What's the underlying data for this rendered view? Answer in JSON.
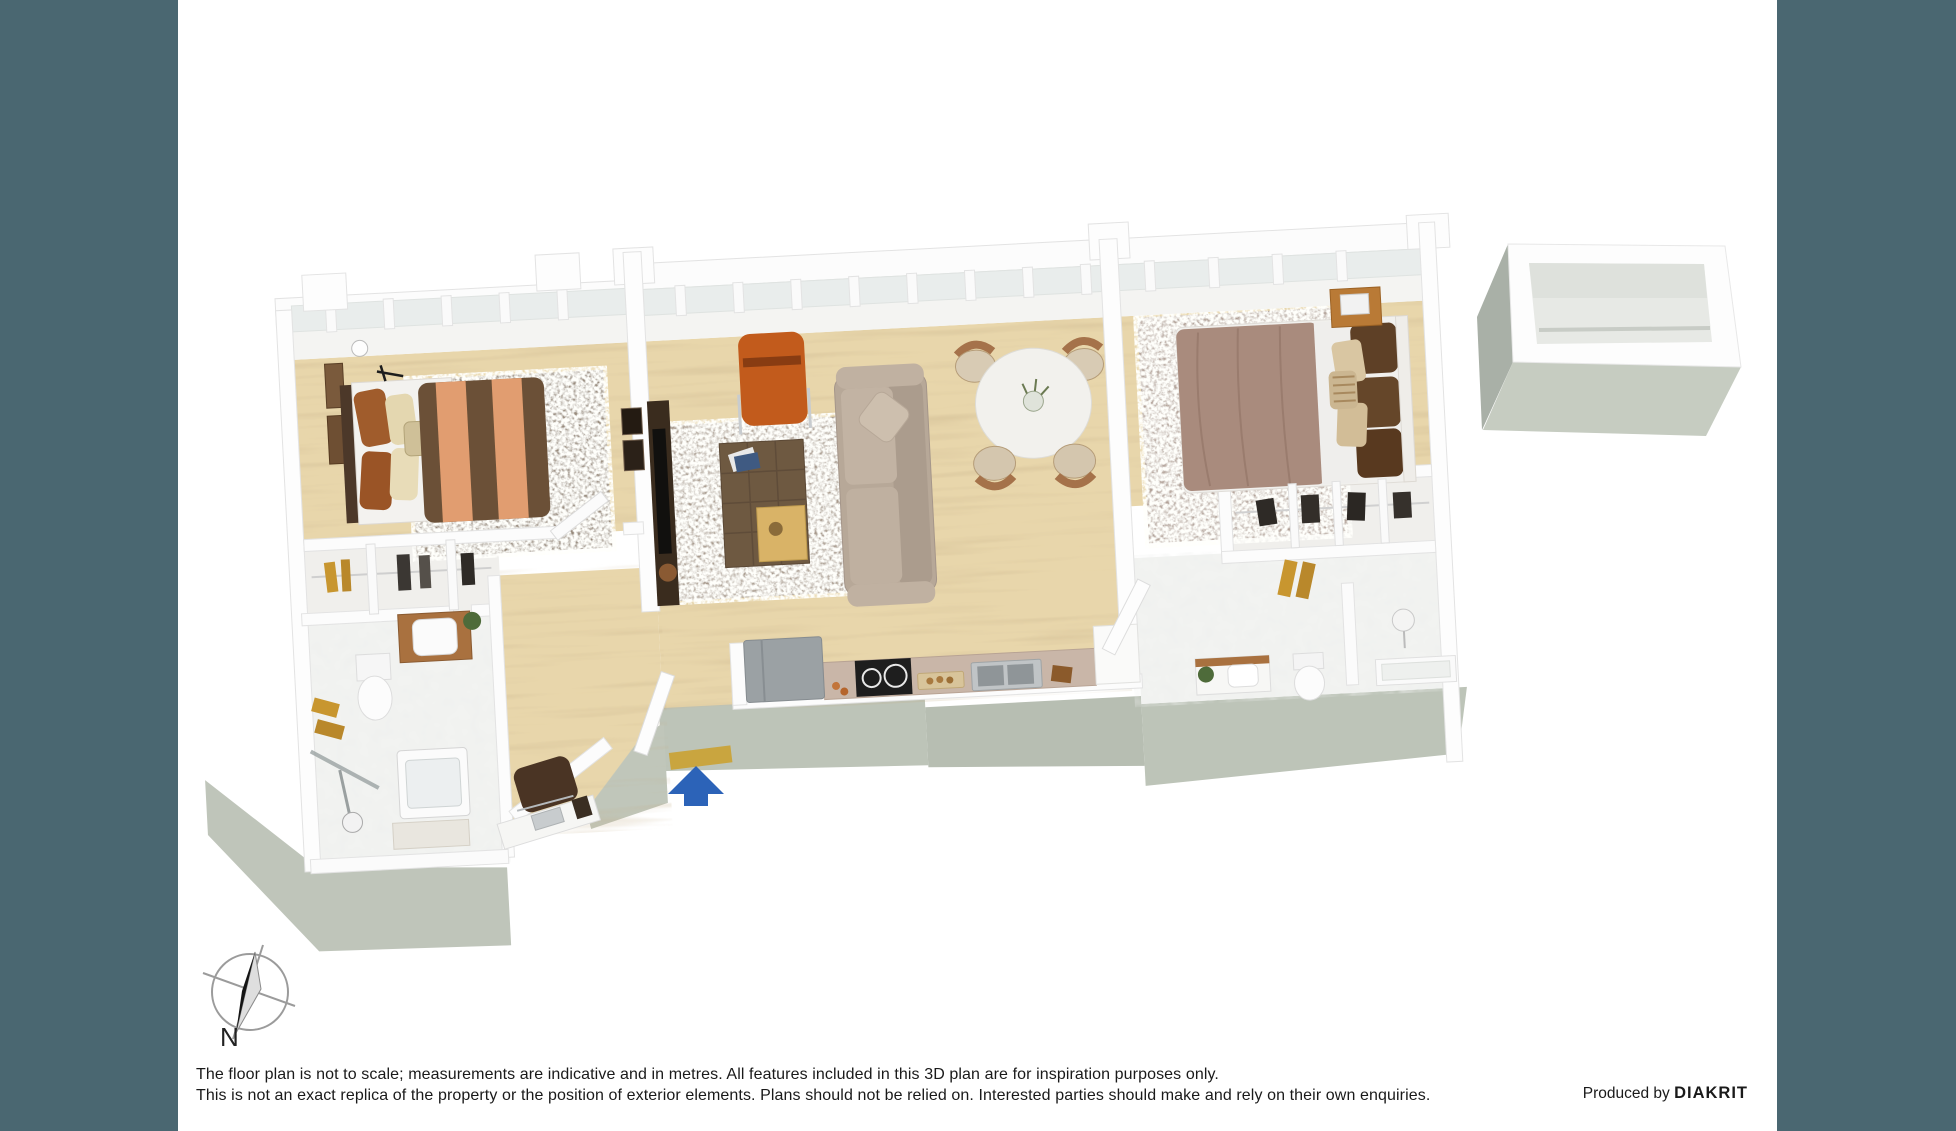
{
  "frame": {
    "bar_color": "#4a6771"
  },
  "compass": {
    "label": "N"
  },
  "disclaimer": {
    "line1": "The floor plan is not to scale; measurements are indicative and in metres. All features included in this 3D plan are for inspiration purposes only.",
    "line2": "This is not an exact replica of the property or the position of exterior elements. Plans should not be relied on. Interested parties should make and rely on their own enquiries."
  },
  "credit": {
    "prefix": "Produced by ",
    "brand": "DIAKRIT"
  },
  "colors": {
    "side_bar": "#4a6771",
    "entry_arrow": "#2c63b8",
    "accent_orange": "#c25b1c",
    "wood_floor": "#e8d6ab",
    "rug_living": "#a89a8c",
    "rug_bed1": "#97897a",
    "rug_bed2": "#b1a096",
    "counter": "#c9b6a8",
    "foundation": "#bfc5ba",
    "gold": "#c8962f",
    "door_mat": "#c9a53f"
  }
}
